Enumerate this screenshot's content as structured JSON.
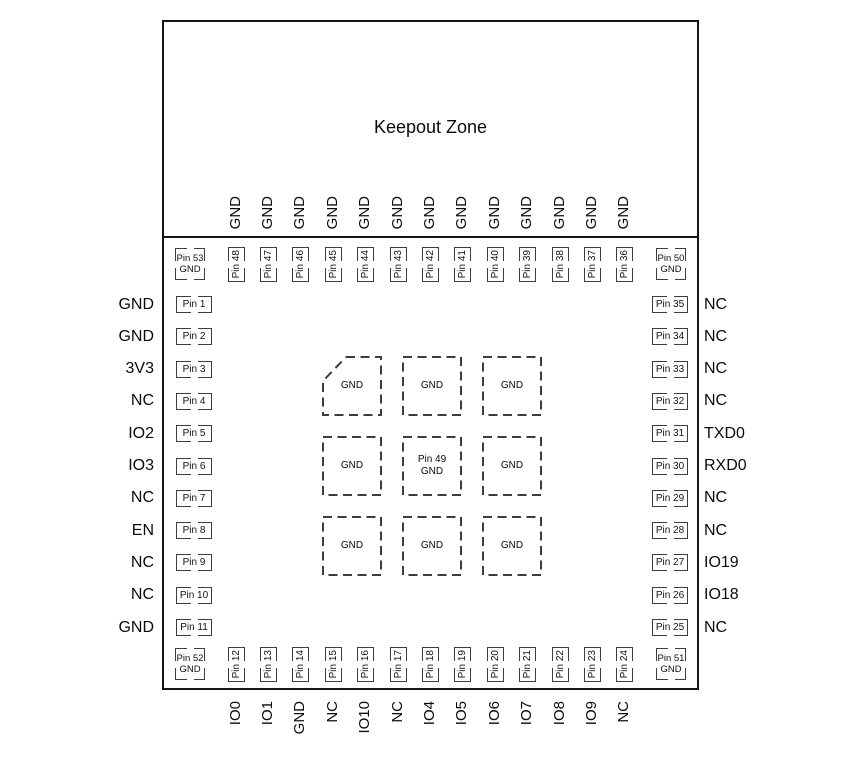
{
  "title": "Keepout Zone",
  "colors": {
    "background": "#ffffff",
    "line": "#161616",
    "pad_outline": "#3d3d3d",
    "text": "#111111"
  },
  "top_pins": [
    {
      "pin": "Pin 48",
      "label": "GND"
    },
    {
      "pin": "Pin 47",
      "label": "GND"
    },
    {
      "pin": "Pin 46",
      "label": "GND"
    },
    {
      "pin": "Pin 45",
      "label": "GND"
    },
    {
      "pin": "Pin 44",
      "label": "GND"
    },
    {
      "pin": "Pin 43",
      "label": "GND"
    },
    {
      "pin": "Pin 42",
      "label": "GND"
    },
    {
      "pin": "Pin 41",
      "label": "GND"
    },
    {
      "pin": "Pin 40",
      "label": "GND"
    },
    {
      "pin": "Pin 39",
      "label": "GND"
    },
    {
      "pin": "Pin 38",
      "label": "GND"
    },
    {
      "pin": "Pin 37",
      "label": "GND"
    },
    {
      "pin": "Pin 36",
      "label": "GND"
    }
  ],
  "bottom_pins": [
    {
      "pin": "Pin 12",
      "label": "IO0"
    },
    {
      "pin": "Pin 13",
      "label": "IO1"
    },
    {
      "pin": "Pin 14",
      "label": "GND"
    },
    {
      "pin": "Pin 15",
      "label": "NC"
    },
    {
      "pin": "Pin 16",
      "label": "IO10"
    },
    {
      "pin": "Pin 17",
      "label": "NC"
    },
    {
      "pin": "Pin 18",
      "label": "IO4"
    },
    {
      "pin": "Pin 19",
      "label": "IO5"
    },
    {
      "pin": "Pin 20",
      "label": "IO6"
    },
    {
      "pin": "Pin 21",
      "label": "IO7"
    },
    {
      "pin": "Pin 22",
      "label": "IO8"
    },
    {
      "pin": "Pin 23",
      "label": "IO9"
    },
    {
      "pin": "Pin 24",
      "label": "NC"
    }
  ],
  "left_pins": [
    {
      "pin": "Pin 1",
      "label": "GND"
    },
    {
      "pin": "Pin 2",
      "label": "GND"
    },
    {
      "pin": "Pin 3",
      "label": "3V3"
    },
    {
      "pin": "Pin 4",
      "label": "NC"
    },
    {
      "pin": "Pin 5",
      "label": "IO2"
    },
    {
      "pin": "Pin 6",
      "label": "IO3"
    },
    {
      "pin": "Pin 7",
      "label": "NC"
    },
    {
      "pin": "Pin 8",
      "label": "EN"
    },
    {
      "pin": "Pin 9",
      "label": "NC"
    },
    {
      "pin": "Pin 10",
      "label": "NC"
    },
    {
      "pin": "Pin 11",
      "label": "GND"
    }
  ],
  "right_pins": [
    {
      "pin": "Pin 35",
      "label": "NC"
    },
    {
      "pin": "Pin 34",
      "label": "NC"
    },
    {
      "pin": "Pin 33",
      "label": "NC"
    },
    {
      "pin": "Pin 32",
      "label": "NC"
    },
    {
      "pin": "Pin 31",
      "label": "TXD0"
    },
    {
      "pin": "Pin 30",
      "label": "RXD0"
    },
    {
      "pin": "Pin 29",
      "label": "NC"
    },
    {
      "pin": "Pin 28",
      "label": "NC"
    },
    {
      "pin": "Pin 27",
      "label": "IO19"
    },
    {
      "pin": "Pin 26",
      "label": "IO18"
    },
    {
      "pin": "Pin 25",
      "label": "NC"
    }
  ],
  "corner_pins": {
    "top_left": {
      "pin": "Pin 53",
      "label": "GND"
    },
    "top_right": {
      "pin": "Pin 50",
      "label": "GND"
    },
    "bottom_left": {
      "pin": "Pin 52",
      "label": "GND"
    },
    "bottom_right": {
      "pin": "Pin 51",
      "label": "GND"
    }
  },
  "center_pads": [
    {
      "label": "GND"
    },
    {
      "label": "GND"
    },
    {
      "label": "GND"
    },
    {
      "label": "GND"
    },
    {
      "pin": "Pin 49",
      "label": "GND"
    },
    {
      "label": "GND"
    },
    {
      "label": "GND"
    },
    {
      "label": "GND"
    },
    {
      "label": "GND"
    }
  ]
}
